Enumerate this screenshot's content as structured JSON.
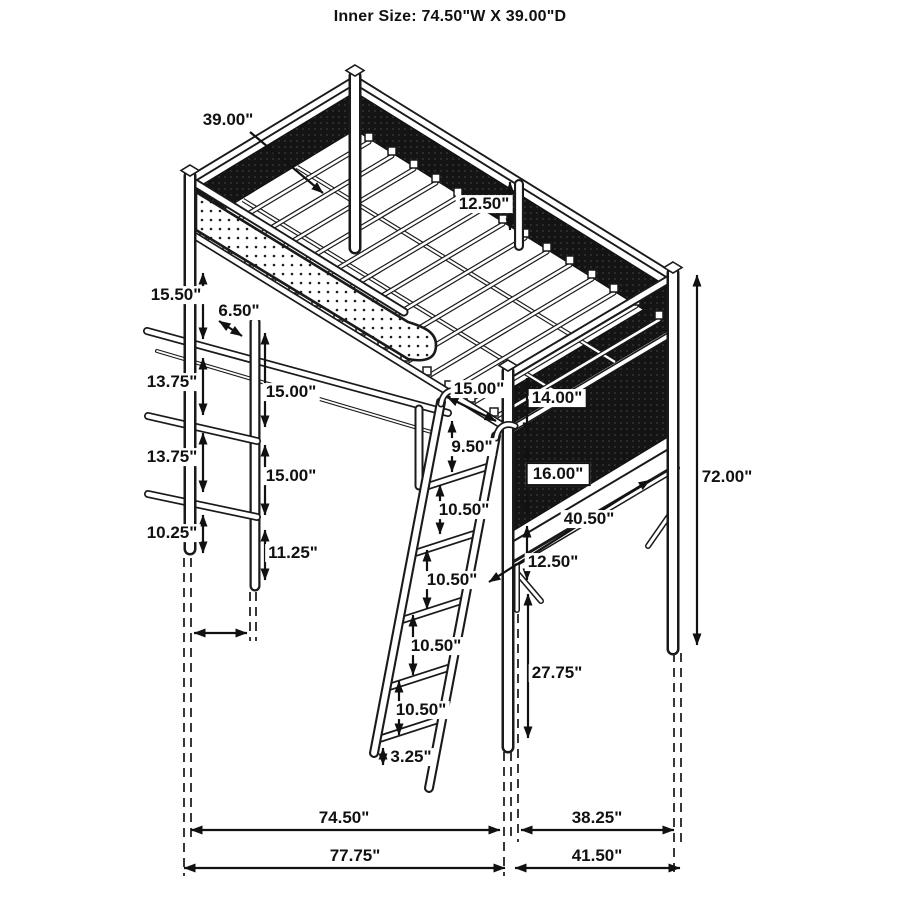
{
  "title": "Inner Size: 74.50\"W X 39.00\"D",
  "diagram": {
    "description": "Isometric dimension drawing of a metal loft bed with under-bed desk, left shelf tower, right-side desk and front ladder",
    "line_color": "#1a1a1a",
    "mesh_color": "#141414",
    "background_color": "#ffffff",
    "inner_size": {
      "width_in": 74.5,
      "depth_in": 39.0
    },
    "dimension_labels": [
      {
        "text": "39.00\"",
        "x": 228,
        "y": 120,
        "boxed": false
      },
      {
        "text": "12.50\"",
        "x": 484,
        "y": 204,
        "boxed": false
      },
      {
        "text": "15.50\"",
        "x": 176,
        "y": 295,
        "boxed": false
      },
      {
        "text": "6.50\"",
        "x": 239,
        "y": 311,
        "boxed": false
      },
      {
        "text": "13.75\"",
        "x": 172,
        "y": 382,
        "boxed": false
      },
      {
        "text": "15.00\"",
        "x": 291,
        "y": 392,
        "boxed": false
      },
      {
        "text": "15.00\"",
        "x": 479,
        "y": 389,
        "boxed": false
      },
      {
        "text": "14.00\"",
        "x": 557,
        "y": 398,
        "boxed": false
      },
      {
        "text": "13.75\"",
        "x": 172,
        "y": 457,
        "boxed": false
      },
      {
        "text": "9.50\"",
        "x": 472,
        "y": 447,
        "boxed": false
      },
      {
        "text": "15.00\"",
        "x": 291,
        "y": 476,
        "boxed": false
      },
      {
        "text": "16.00\"",
        "x": 558,
        "y": 474,
        "boxed": true
      },
      {
        "text": "10.25\"",
        "x": 172,
        "y": 533,
        "boxed": false
      },
      {
        "text": "40.50\"",
        "x": 589,
        "y": 519,
        "boxed": false
      },
      {
        "text": "11.25\"",
        "x": 293,
        "y": 553,
        "boxed": false
      },
      {
        "text": "12.50\"",
        "x": 553,
        "y": 562,
        "boxed": false
      },
      {
        "text": "10.50\"",
        "x": 464,
        "y": 510,
        "boxed": false
      },
      {
        "text": "72.00\"",
        "x": 727,
        "y": 477,
        "boxed": false
      },
      {
        "text": "10.50\"",
        "x": 452,
        "y": 580,
        "boxed": false
      },
      {
        "text": "27.75\"",
        "x": 557,
        "y": 673,
        "boxed": false
      },
      {
        "text": "10.50\"",
        "x": 436,
        "y": 646,
        "boxed": false
      },
      {
        "text": "10.50\"",
        "x": 421,
        "y": 710,
        "boxed": false
      },
      {
        "text": "3.25\"",
        "x": 411,
        "y": 757,
        "boxed": false
      },
      {
        "text": "74.50\"",
        "x": 344,
        "y": 818,
        "boxed": false
      },
      {
        "text": "38.25\"",
        "x": 597,
        "y": 818,
        "boxed": false
      },
      {
        "text": "77.75\"",
        "x": 355,
        "y": 856,
        "boxed": false
      },
      {
        "text": "41.50\"",
        "x": 597,
        "y": 856,
        "boxed": false
      }
    ]
  }
}
